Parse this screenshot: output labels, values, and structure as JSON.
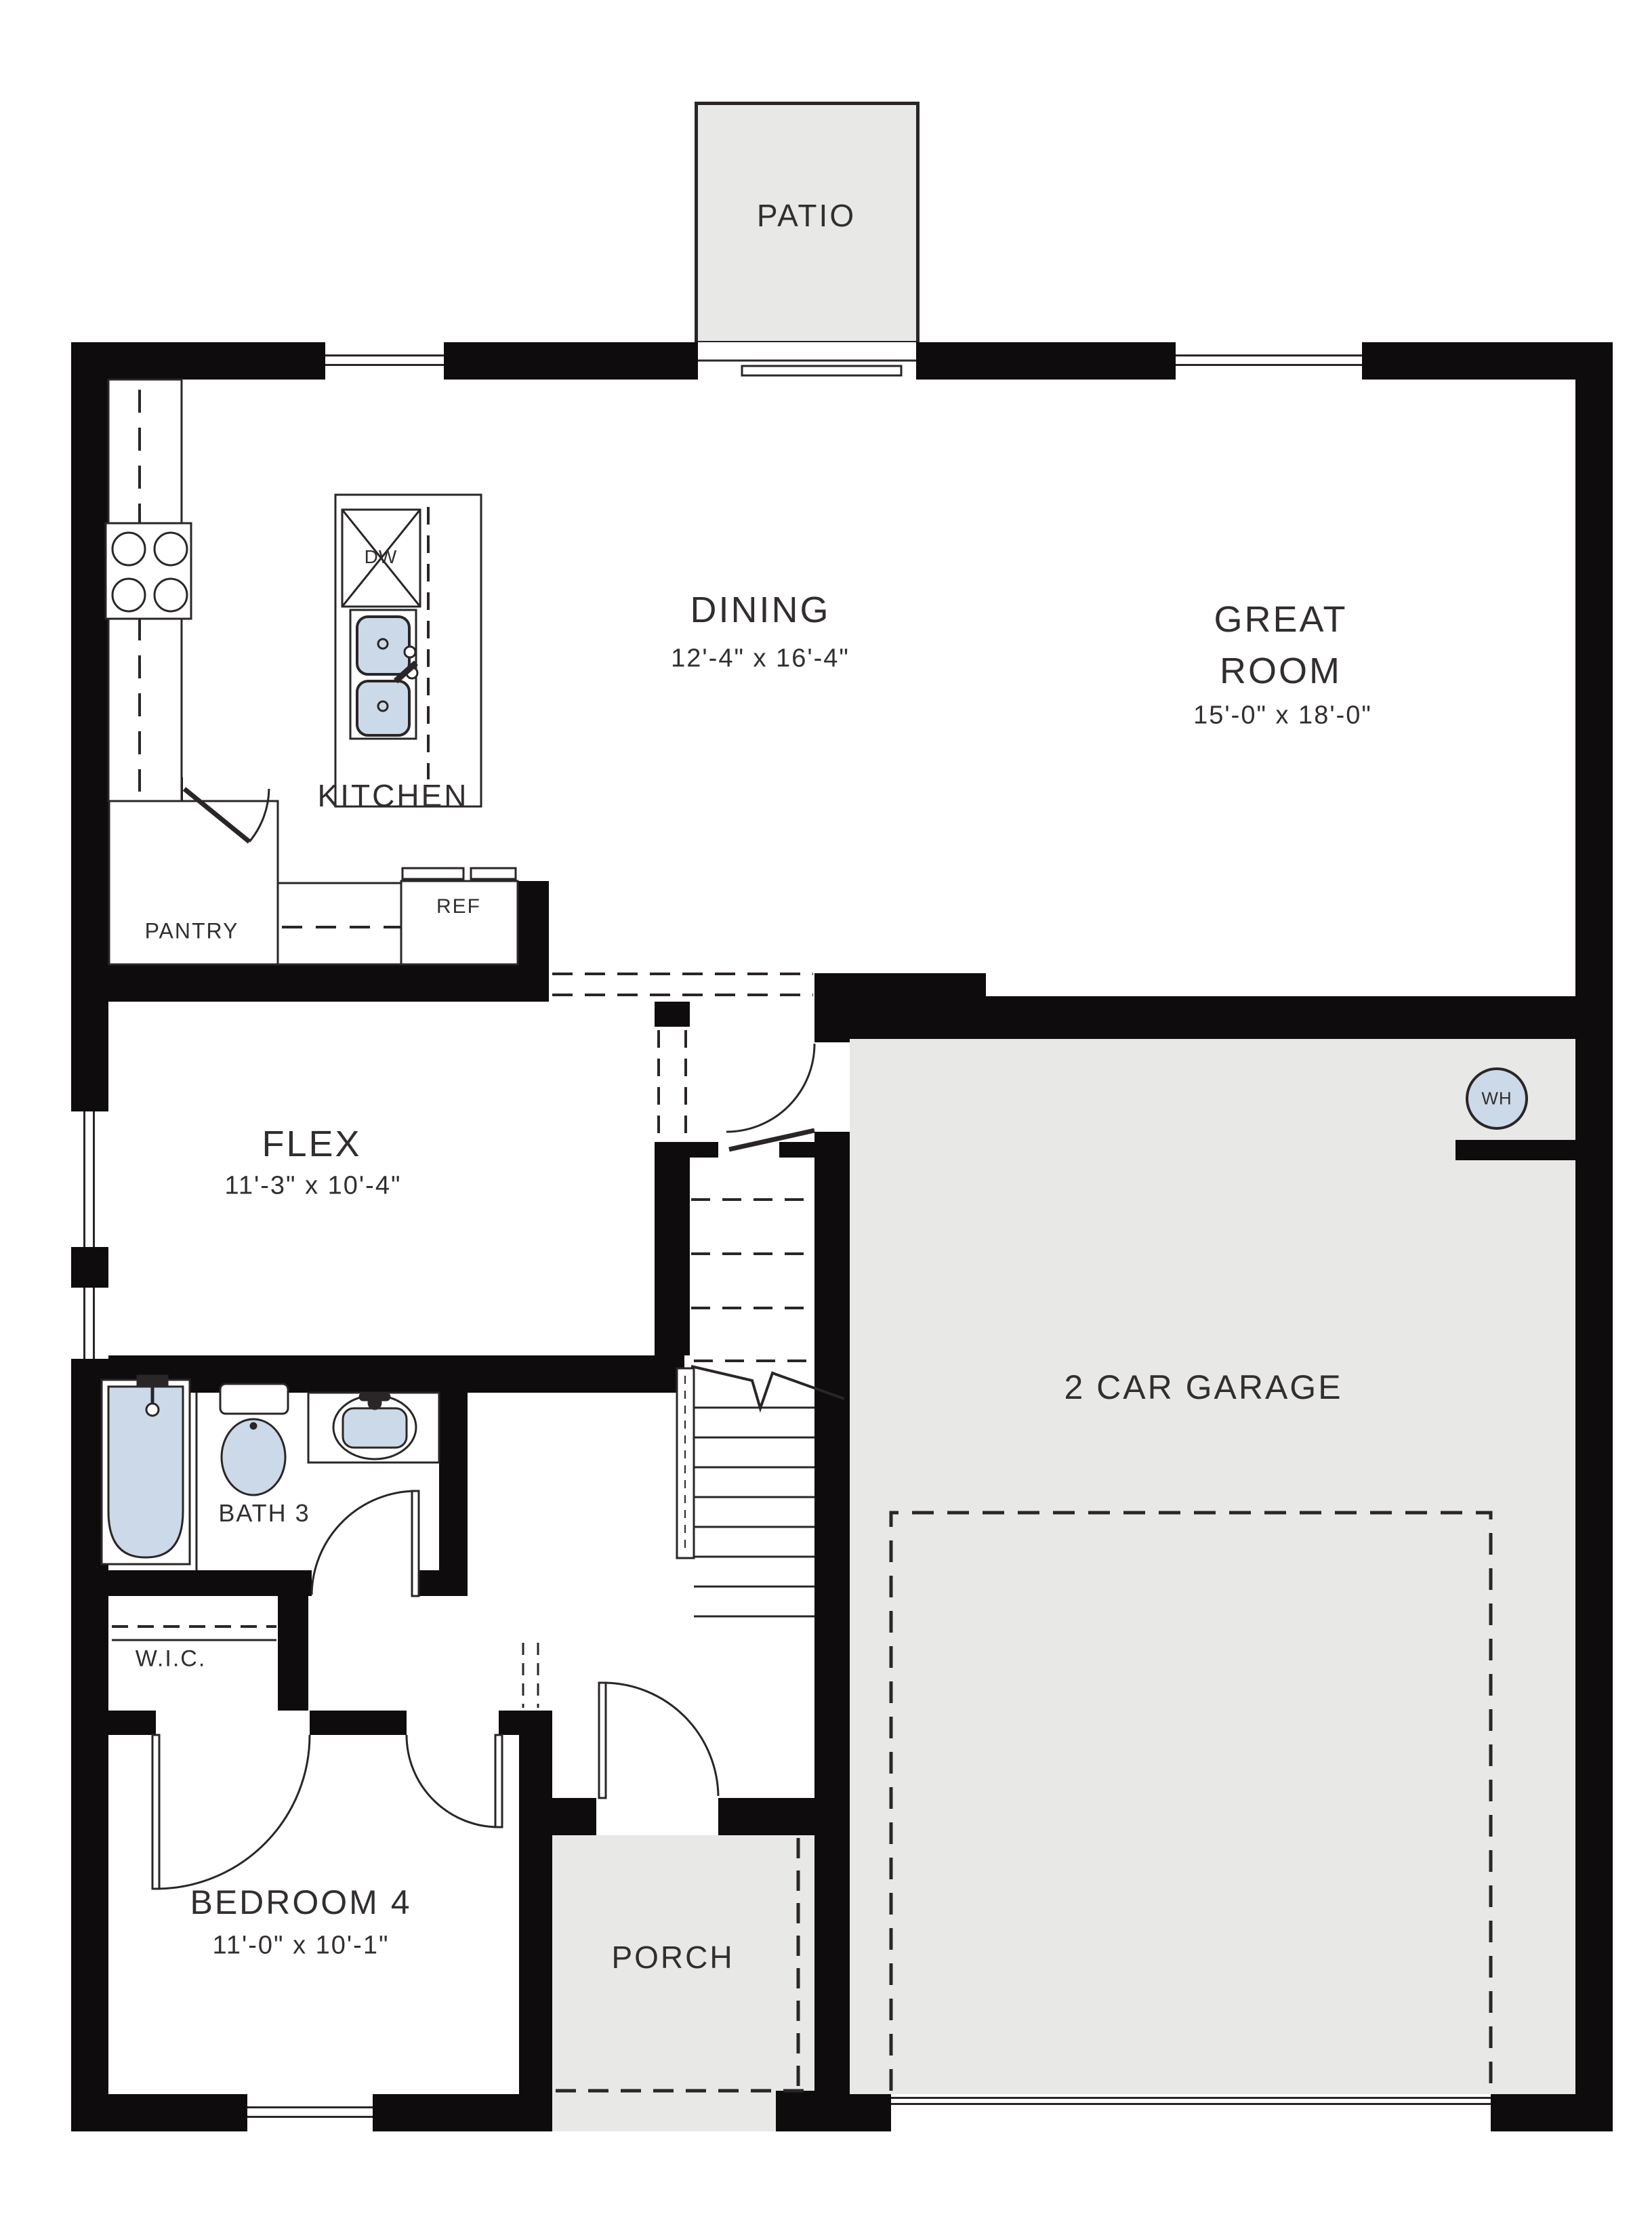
{
  "rooms": {
    "patio": {
      "label": "PATIO"
    },
    "dining": {
      "label": "DINING",
      "dims": "12'-4\" x 16'-4\""
    },
    "great_room": {
      "label": "GREAT ROOM",
      "dims": "15'-0\" x 18'-0\""
    },
    "kitchen": {
      "label": "KITCHEN"
    },
    "pantry": {
      "label": "PANTRY"
    },
    "flex": {
      "label": "FLEX",
      "dims": "11'-3\" x 10'-4\""
    },
    "garage": {
      "label": "2 CAR GARAGE"
    },
    "bath3": {
      "label": "BATH 3"
    },
    "wic": {
      "label": "W.I.C."
    },
    "bedroom4": {
      "label": "BEDROOM 4",
      "dims": "11'-0\" x 10'-1\""
    },
    "porch": {
      "label": "PORCH"
    }
  },
  "fixtures": {
    "dishwasher": "DW",
    "refrigerator": "REF",
    "water_heater": "WH"
  },
  "colors": {
    "wall": "#0e0c0d",
    "area_fill": "#e8e8e7",
    "fixture_fill": "#ccd9e8",
    "line": "#2a2627",
    "text": "#322e2f"
  }
}
